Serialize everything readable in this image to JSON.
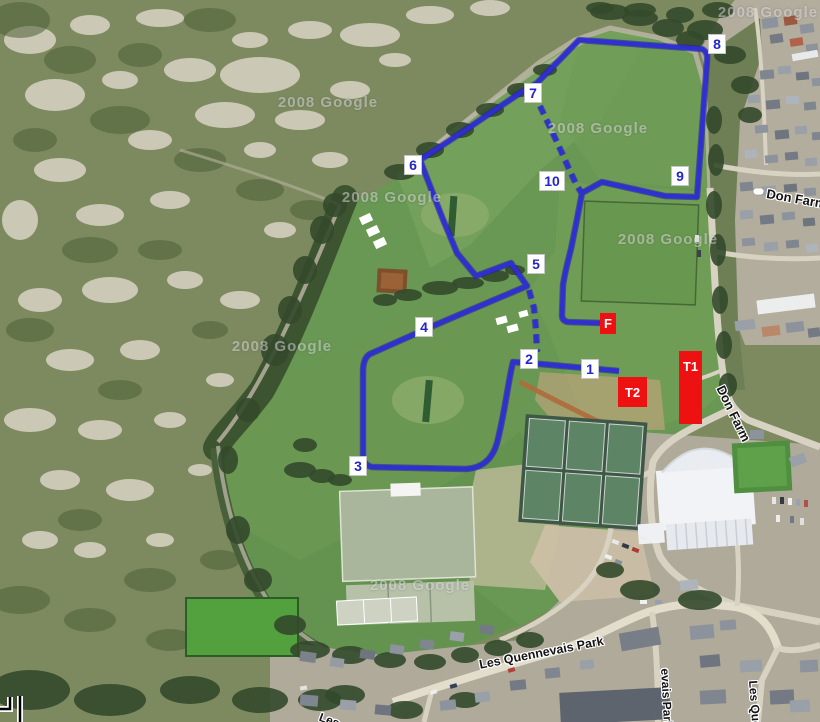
{
  "watermark": {
    "text": "2008 Google"
  },
  "course": {
    "checkpoint_labels": [
      "1",
      "2",
      "3",
      "4",
      "5",
      "6",
      "7",
      "8",
      "9",
      "10"
    ],
    "markers": {
      "transition1": "T1",
      "transition2": "T2",
      "finish": "F"
    },
    "route_color": "#2e2ed4",
    "checkpoint_text_color": "#2326c8",
    "special_marker_color": "#ee1111"
  },
  "road_labels": {
    "don_farm_upper": "Don Farm",
    "don_farm_lower": "Don Farm",
    "les_quennevais_park": "Les Quennevais Park",
    "fragment_vertical_left": "evais Park",
    "fragment_vertical_right": "Les Que",
    "fragment_bottom_left": "Les"
  }
}
